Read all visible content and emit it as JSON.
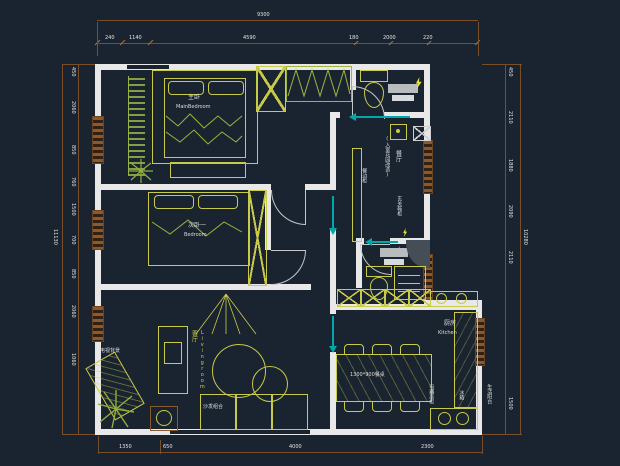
{
  "colors": {
    "background": "#1a2430",
    "wall": "#e8e8e8",
    "furniture_yellow": "#c9c94a",
    "plant_green": "#8fae3c",
    "dimension_brown": "#8a5a2e",
    "door_teal": "#00a8a8",
    "fixture_gray": "#b9bcbf",
    "text_white": "#dcdcdc",
    "text_yellow": "#cfcf4a"
  },
  "rooms": {
    "master": {
      "cn": "主卧",
      "en": "MainBedroom"
    },
    "bedroom2": {
      "cn": "次卧一",
      "en": "Bedroom"
    },
    "living": {
      "cn": "客厅",
      "en": "Livingroom"
    },
    "dining": {
      "cn": "餐厅",
      "note": "(入室花园改造)"
    },
    "kitchen": {
      "cn": "厨房",
      "en": "Kitchen"
    }
  },
  "labels": {
    "tv_wall": "电视背景",
    "sofa": "沙发组合",
    "sideboard": "餐边柜",
    "entry_cabinet": "玄关鞋柜",
    "dining_table": "1300*900餐桌",
    "appliance_cabinet": "电器高柜",
    "fridge": "冰箱",
    "service_balcony": "生活阳台"
  },
  "dimensions": {
    "top_overall": "9300",
    "top_chain": [
      "240",
      "1140",
      "4590",
      "180",
      "2000",
      "220"
    ],
    "left_overall": "11130",
    "left_chain": [
      "450",
      "2060",
      "850",
      "760",
      "1500",
      "700",
      "850",
      "2060",
      "1060"
    ],
    "right_overall": "10280",
    "right_chain": [
      "450",
      "2110",
      "1880",
      "2090",
      "2110",
      "1500"
    ],
    "bottom_chain": [
      "1350",
      "650",
      "4000",
      "2300"
    ]
  }
}
